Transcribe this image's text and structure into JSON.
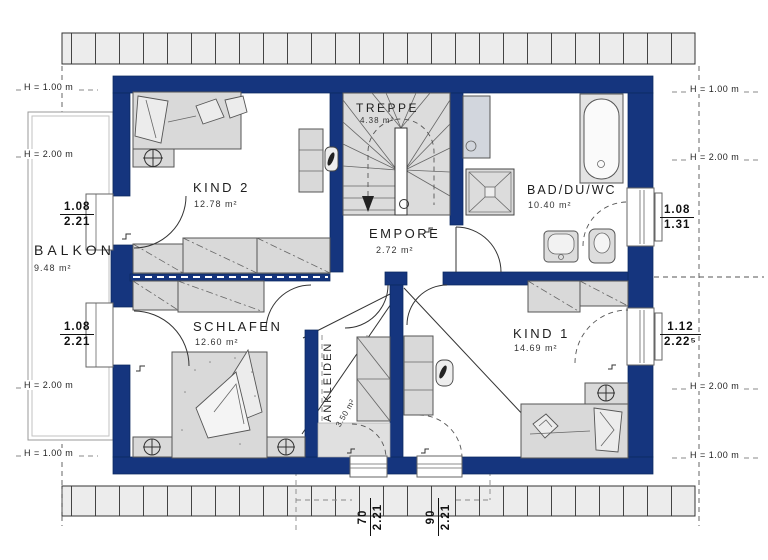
{
  "colors": {
    "wall": "#15357e",
    "furniture": "#d9d9d9",
    "hatch": "#ececec"
  },
  "rooms": {
    "balkon": {
      "name": "BALKON",
      "area": "9.48 m²"
    },
    "kind2": {
      "name": "KIND 2",
      "area": "12.78 m²"
    },
    "treppe": {
      "name": "TREPPE",
      "area": "4.38 m²"
    },
    "bad": {
      "name": "BAD/DU/WC",
      "area": "10.40 m²"
    },
    "empore": {
      "name": "EMPORE",
      "area": "2.72 m²"
    },
    "schlafen": {
      "name": "SCHLAFEN",
      "area": "12.60 m²"
    },
    "ankleiden": {
      "name": "ANKLEIDEN",
      "area": "3.50 m²"
    },
    "kind1": {
      "name": "KIND 1",
      "area": "14.69 m²"
    }
  },
  "height_lines": {
    "left": [
      "H = 1.00 m",
      "H = 2.00 m",
      "H = 2.00 m",
      "H = 1.00 m"
    ],
    "right": [
      "H = 1.00 m",
      "H = 2.00 m",
      "H = 2.00 m",
      "H = 1.00 m"
    ]
  },
  "openings": {
    "left_top": {
      "w": "1.08",
      "h": "2.21"
    },
    "left_bottom": {
      "w": "1.08",
      "h": "2.21"
    },
    "right_top": {
      "w": "1.08",
      "h": "1.31"
    },
    "right_bottom": {
      "w": "1.12",
      "h": "2.22⁵"
    },
    "bottom_left": {
      "w": "70",
      "h": "2.21"
    },
    "bottom_right": {
      "w": "90",
      "h": "2.21"
    }
  }
}
